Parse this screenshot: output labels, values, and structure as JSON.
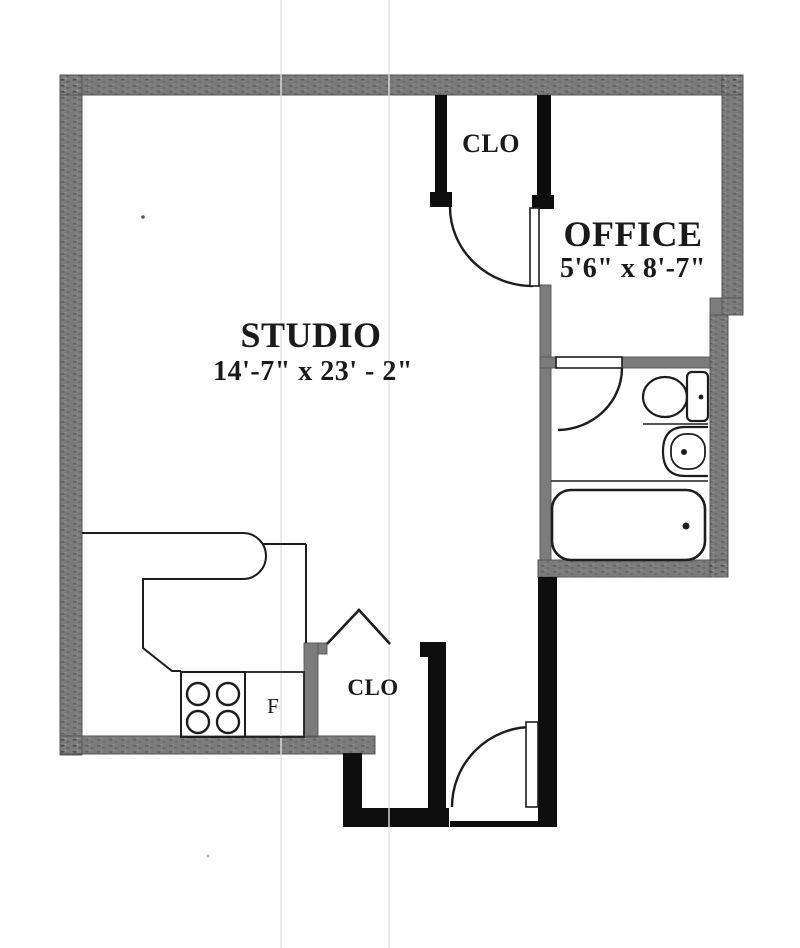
{
  "colors": {
    "wall_gray": "#7c7c7c",
    "partition_black": "#0e0e0e",
    "line": "#1d1d1d",
    "label": "#1a1a1a",
    "fold_line": "#e2e2e2"
  },
  "rooms": {
    "studio": {
      "name": "STUDIO",
      "dimensions": "14'-7\" x 23' - 2\""
    },
    "office": {
      "name": "OFFICE",
      "dimensions": "5'6\" x 8'-7\""
    },
    "closet_top": {
      "name": "CLO"
    },
    "closet_bottom": {
      "name": "CLO"
    },
    "kitchen": {
      "refrigerator_label": "F"
    }
  }
}
